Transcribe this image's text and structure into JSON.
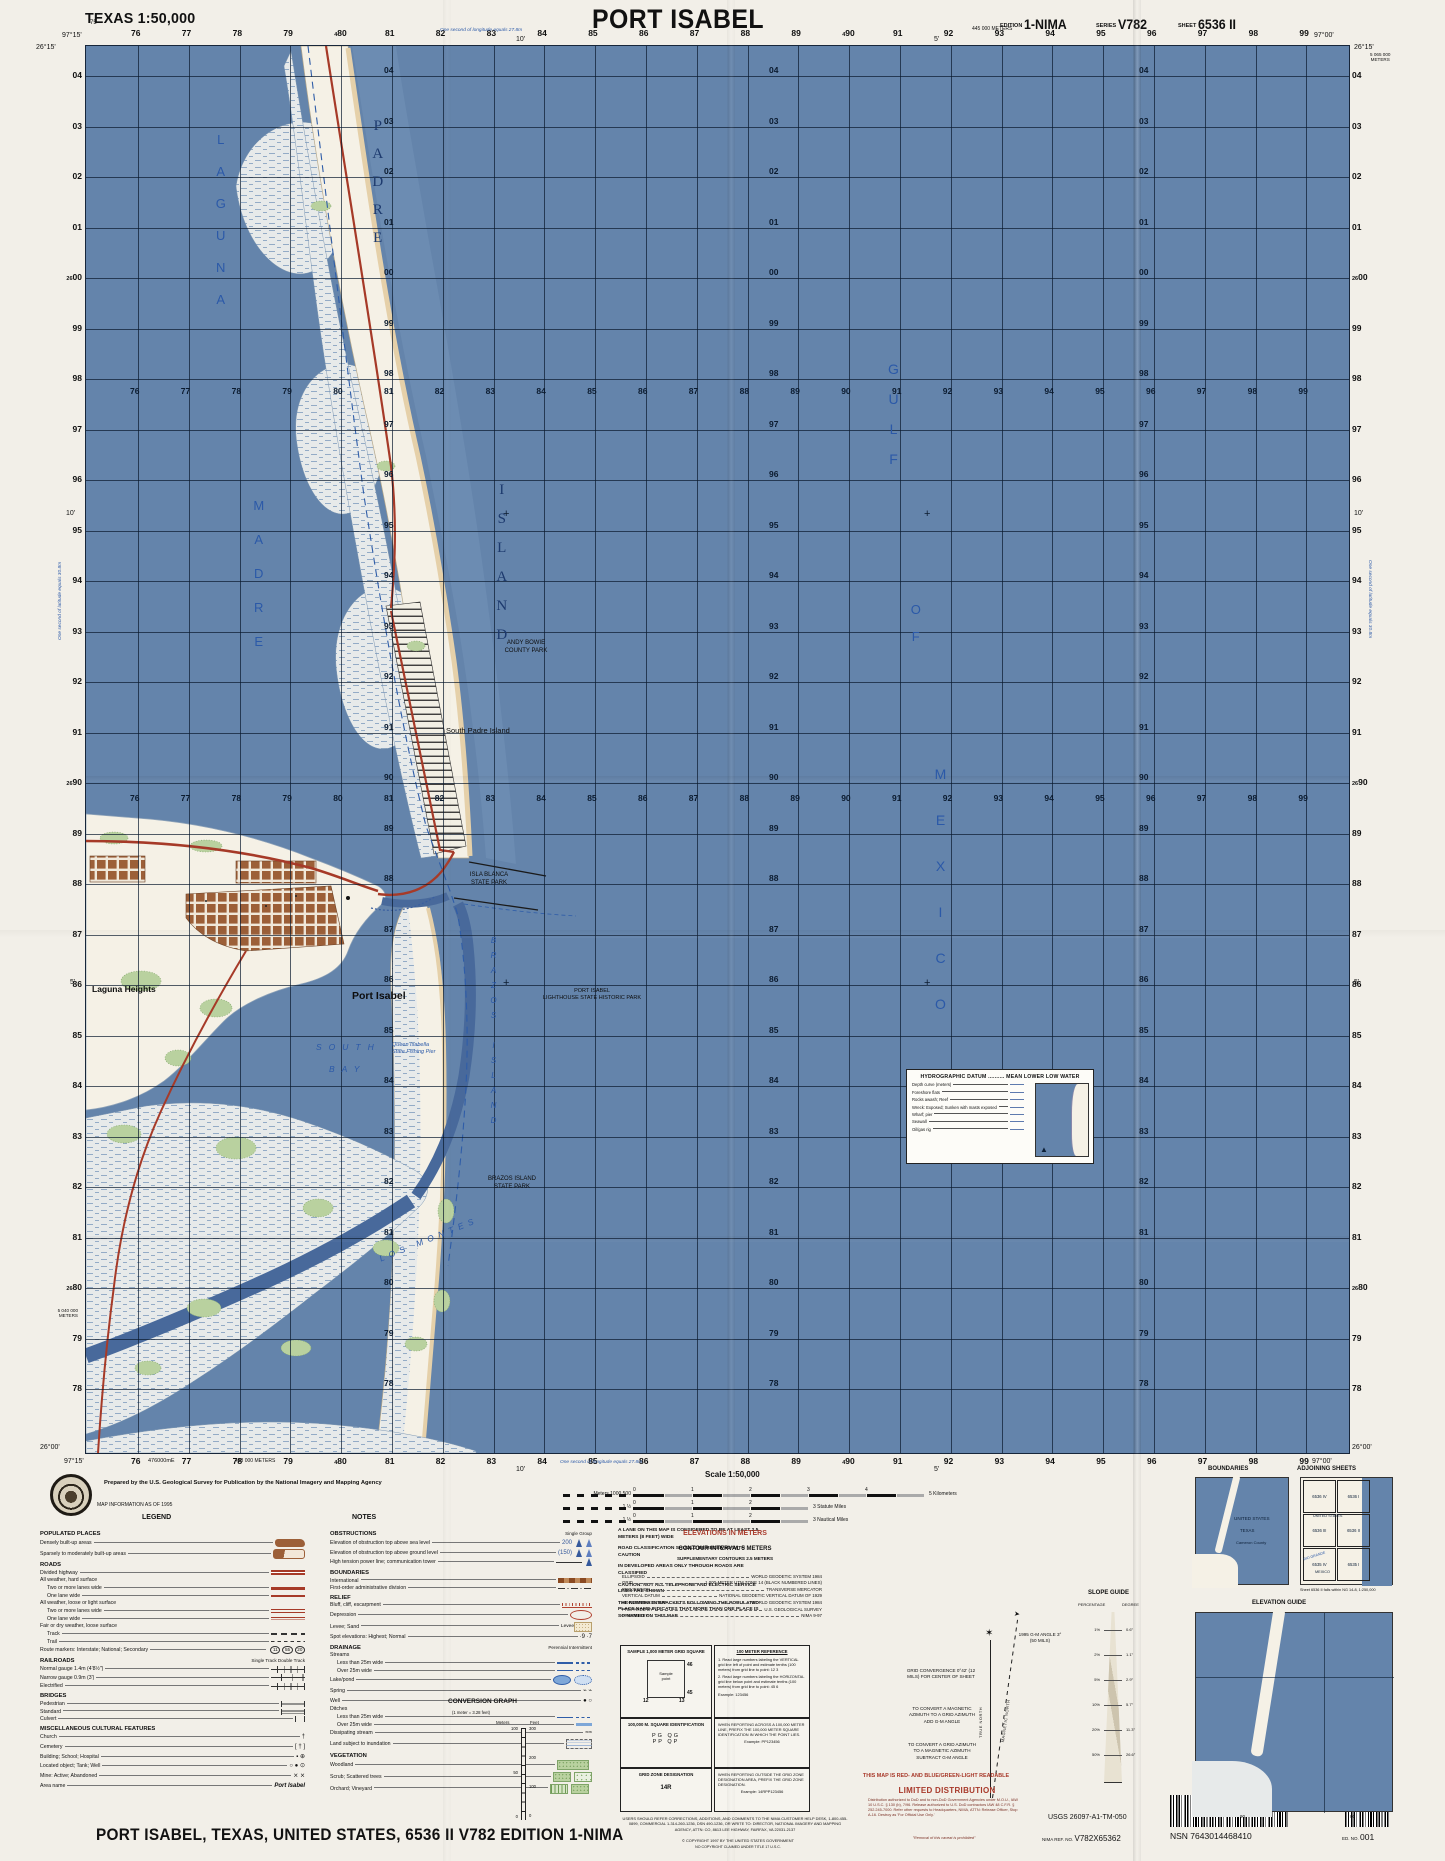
{
  "header": {
    "state_scale": "TEXAS 1:50,000",
    "title": "PORT ISABEL",
    "edition_label": "EDITION",
    "edition": "1-NIMA",
    "series_label": "SERIES",
    "series": "V782",
    "sheet_label": "SHEET",
    "sheet": "6536 II"
  },
  "footer_title": "PORT ISABEL, TEXAS, UNITED STATES,   6536 II   V782   EDITION 1-NIMA",
  "credit": {
    "prepared": "Prepared by the U.S. Geological Survey for Publication by the National Imagery and Mapping Agency",
    "info": "MAP INFORMATION AS OF 1995",
    "legend_heading": "LEGEND",
    "notes_heading": "NOTES"
  },
  "map": {
    "grid": {
      "cols": [
        "76",
        "77",
        "78",
        "79",
        "80",
        "81",
        "82",
        "83",
        "84",
        "85",
        "86",
        "87",
        "88",
        "89",
        "90",
        "91",
        "92",
        "93",
        "94",
        "95",
        "96",
        "97",
        "98",
        "99"
      ],
      "rows": [
        "04",
        "03",
        "02",
        "01",
        "00",
        "99",
        "98",
        "97",
        "96",
        "95",
        "94",
        "93",
        "92",
        "91",
        "90",
        "89",
        "88",
        "87",
        "86",
        "85",
        "84",
        "83",
        "82",
        "81",
        "80",
        "79",
        "78"
      ],
      "row_prefix": "26",
      "col_prefix": "4",
      "prefix_rows": [
        "00",
        "90",
        "80"
      ],
      "prefix_cols": [
        "80",
        "90"
      ]
    },
    "corners": {
      "tl_lon": "97°15'",
      "tl_lat": "26°15'",
      "tr_lon": "97°00'",
      "tr_lat": "26°15'",
      "bl_lat": "26°00'",
      "bl_lon": "97°15'",
      "br_lat": "26°00'",
      "br_lon": "97°00'"
    },
    "edge": {
      "top_m": "445 000 METERS",
      "bottom_m": "433 000 METERS",
      "right_m1": "5 065 000",
      "right_m2": "METERS",
      "left_m1": "5 040 000",
      "left_m2": "METERS",
      "easting": "476000mE",
      "corner75": "75",
      "tick10": "10'",
      "tick5": "5'",
      "lon_note": "One second of longitude equals 27.8m",
      "lat_note": "One second of latitude equals 30.8m"
    },
    "labels": [
      {
        "t": "LAGUNA",
        "x": 126,
        "y": 86,
        "c": "sv",
        "ls": 17,
        "fs": 13
      },
      {
        "t": "MADRE",
        "x": 164,
        "y": 452,
        "c": "sv",
        "ls": 19,
        "fs": 13
      },
      {
        "t": "PADRE",
        "x": 282,
        "y": 72,
        "c": "iv",
        "ls": 12,
        "fs": 15
      },
      {
        "t": "ISLAND",
        "x": 406,
        "y": 436,
        "c": "iv",
        "ls": 13,
        "fs": 15
      },
      {
        "t": "GULF",
        "x": 798,
        "y": 315,
        "c": "sv",
        "ls": 14,
        "fs": 14
      },
      {
        "t": "OF",
        "x": 821,
        "y": 556,
        "c": "sv",
        "ls": 12,
        "fs": 13
      },
      {
        "t": "MEXICO",
        "x": 845,
        "y": 720,
        "c": "sv",
        "ls": 30,
        "fs": 14
      },
      {
        "t": "SOUTH",
        "x": 230,
        "y": 996,
        "c": "sh",
        "ls": 7,
        "fs": 8.5
      },
      {
        "t": "BAY",
        "x": 243,
        "y": 1018,
        "c": "sh",
        "ls": 7,
        "fs": 8.5
      },
      {
        "t": "LOS  MONTES",
        "x": 290,
        "y": 1188,
        "c": "sh",
        "ls": 5,
        "fs": 8.5,
        "r": -22
      },
      {
        "t": "BRAZOS  ISLAND",
        "x": 402,
        "y": 890,
        "c": "ivs",
        "ls": 6,
        "fs": 8
      },
      {
        "t": "Port Isabel",
        "x": 266,
        "y": 944,
        "c": "town",
        "fs": 10.5
      },
      {
        "t": "Laguna Heights",
        "x": 6,
        "y": 938,
        "c": "town",
        "fs": 8.5
      },
      {
        "t": "South Padre Island",
        "x": 360,
        "y": 680,
        "c": "blk",
        "fs": 7.5
      },
      {
        "t": "ANDY BOWIE\nCOUNTY PARK",
        "x": 410,
        "y": 594,
        "c": "park",
        "fs": 6,
        "w": 60
      },
      {
        "t": "ISLA BLANCA\nSTATE PARK",
        "x": 374,
        "y": 826,
        "c": "park",
        "fs": 6,
        "w": 58
      },
      {
        "t": "BRAZOS ISLAND\nSTATE PARK",
        "x": 394,
        "y": 1130,
        "c": "park",
        "fs": 6,
        "w": 64
      },
      {
        "t": "PORT ISABEL\nLIGHTHOUSE STATE HISTORIC PARK",
        "x": 446,
        "y": 942,
        "c": "park",
        "fs": 5.5,
        "w": 120
      },
      {
        "t": "Queen Isabella\nState Fishing Pier",
        "x": 306,
        "y": 996,
        "c": "bluesm",
        "fs": 5.5,
        "w": 55
      }
    ],
    "hydro": {
      "title": "HYDROGRAPHIC DATUM",
      "dots": "..........",
      "value": "MEAN LOWER LOW WATER",
      "rows": [
        "Depth curve (meters)",
        "Foreshore flats",
        "Rocks awash; Reef",
        "Wreck: Exposed; Sunken with masts exposed",
        "Wharf; pier",
        "Seawall",
        "Oil/gas rig"
      ]
    }
  },
  "legend": {
    "col1": [
      {
        "h": "POPULATED PLACES"
      },
      {
        "t": "Densely built-up areas",
        "s": "blob"
      },
      {
        "t": "Sparsely to moderately built-up areas",
        "s": "blob2"
      },
      {
        "h": "ROADS"
      },
      {
        "t": "Divided highway",
        "s": "rdbl"
      },
      {
        "g": "All weather, hard surface"
      },
      {
        "t": "Two or more lanes wide",
        "s": "rthick",
        "ind": 1
      },
      {
        "t": "One lane wide",
        "s": "rthin",
        "ind": 1
      },
      {
        "g": "All weather, loose or light surface"
      },
      {
        "t": "Two or more lanes wide",
        "s": "rpar",
        "ind": 1
      },
      {
        "t": "One lane wide",
        "s": "rparthin",
        "ind": 1
      },
      {
        "g": "Fair or dry weather, loose surface"
      },
      {
        "t": "Track",
        "s": "bdash",
        "ind": 1
      },
      {
        "t": "Trail",
        "s": "bdashf",
        "ind": 1
      },
      {
        "t": "Route markers: Interstate; National; Secondary",
        "s": "shields",
        "v": "11|55|20"
      },
      {
        "h": "RAILROADS",
        "n": "Single Track      Double Track"
      },
      {
        "t": "Normal gauge 1.4m (4'8½\")",
        "s": "rr"
      },
      {
        "t": "Narrow gauge 0.9m (3')",
        "s": "rr2"
      },
      {
        "t": "Electrified",
        "s": "rr"
      },
      {
        "h": "BRIDGES"
      },
      {
        "t": "Pedestrian",
        "s": "br"
      },
      {
        "t": "Standard",
        "s": "br2"
      },
      {
        "t": "Culvert",
        "s": "br3"
      },
      {
        "h": "MISCELLANEOUS CULTURAL FEATURES"
      },
      {
        "t": "Church",
        "s": "txt",
        "v": "†"
      },
      {
        "t": "Cemetery",
        "s": "txt",
        "v": "[ † ]"
      },
      {
        "t": "Building; School; Hospital",
        "s": "txt",
        "v": "▪  ⊕"
      },
      {
        "t": "Located object; Tank; Well",
        "s": "txt",
        "v": "○ ● ⊙"
      },
      {
        "t": "Mine: Active; Abandoned",
        "s": "txt",
        "v": "⨯  ⨯"
      },
      {
        "t": "Area name",
        "s": "txt",
        "v": "Port Isabel",
        "bold": true
      }
    ],
    "col2": [
      {
        "h": "OBSTRUCTIONS",
        "n": "Single    Group"
      },
      {
        "t": "Elevation of obstruction top above sea level",
        "s": "tower",
        "v": "200"
      },
      {
        "t": "Elevation of obstruction top above ground level",
        "s": "tower",
        "v": "(150)"
      },
      {
        "t": "High tension power line; communication tower",
        "s": "power"
      },
      {
        "h": "BOUNDARIES"
      },
      {
        "t": "International",
        "s": "bint"
      },
      {
        "t": "First-order administrative division",
        "s": "badm"
      },
      {
        "h": "RELIEF"
      },
      {
        "t": "Bluff, cliff, escarpment",
        "s": "bluff"
      },
      {
        "t": "Depression",
        "s": "depr"
      },
      {
        "t": "Levee; Sand",
        "s": "levee",
        "v": "Levee"
      },
      {
        "t": "Spot elevations: Highest; Normal",
        "s": "txt",
        "v": "·9    ·7"
      },
      {
        "h": "DRAINAGE",
        "n": "Perennial   Intermittent"
      },
      {
        "g": "Streams"
      },
      {
        "t": "Less than 25m wide",
        "s": "stream",
        "ind": 1
      },
      {
        "t": "Over 25m wide",
        "s": "stream",
        "ind": 1
      },
      {
        "t": "Lake/pond",
        "s": "lake"
      },
      {
        "t": "Spring",
        "s": "txt",
        "v": "⌁   ⌁"
      },
      {
        "t": "Well",
        "s": "txt",
        "v": "●   ○"
      },
      {
        "g": "Ditches"
      },
      {
        "t": "Less than 25m wide",
        "s": "stream",
        "ind": 1
      },
      {
        "t": "Over 25m wide",
        "s": "ditch2",
        "ind": 1
      },
      {
        "t": "Dissipating stream",
        "s": "txt",
        "v": "≈≈"
      },
      {
        "t": "Land subject to inundation",
        "s": "inund"
      },
      {
        "h": "VEGETATION"
      },
      {
        "t": "Woodland",
        "s": "veg1"
      },
      {
        "t": "Scrub; Scattered trees",
        "s": "veg2"
      },
      {
        "t": "Orchard; Vineyard",
        "s": "veg3"
      }
    ]
  },
  "notes": {
    "items": [
      "A LANE ON THIS MAP IS CONSIDERED TO BE AT LEAST 2.5 METERS (8 FEET) WIDE",
      "ROAD CLASSIFICATION SHOULD BE RECEIVED WITH CAUTION",
      "IN DEVELOPED AREAS ONLY THROUGH ROADS ARE CLASSIFIED",
      "CAUTION: NOT ALL TELEPHONE AND ELECTRIC SERVICE LINES ARE SHOWN",
      "THE NUMBER IN BRACKETS FOLLOWING THE POPULATED PLACE NAME INDICATES THAT MORE THAN ONE PLACE IS SO NAMED ON THIS MAP"
    ]
  },
  "scale": {
    "heading": "Scale 1:50,000",
    "bars": [
      {
        "pre": "Meters 1000        500",
        "ticks": [
          "0",
          "1",
          "2",
          "3",
          "4"
        ],
        "end": "5 Kilometers"
      },
      {
        "pre": "1                 ½",
        "ticks": [
          "0",
          "1",
          "2"
        ],
        "end": "3 Statute Miles"
      },
      {
        "pre": "1                 ½",
        "ticks": [
          "0",
          "1",
          "2"
        ],
        "end": "3 Nautical Miles"
      }
    ]
  },
  "elev": {
    "heading": "ELEVATIONS IN METERS",
    "ci": "CONTOUR INTERVAL 5 METERS",
    "supp": "SUPPLEMENTARY CONTOURS 2.5 METERS"
  },
  "datum": [
    [
      "ELLIPSOID",
      "WORLD GEODETIC SYSTEM 1984"
    ],
    [
      "GRID",
      "1,000-METER UTM ZONE 14 (BLACK NUMBERED LINES)"
    ],
    [
      "PROJECTION",
      "TRANSVERSE MERCATOR"
    ],
    [
      "VERTICAL DATUM",
      "NATIONAL GEODETIC VERTICAL DATUM OF 1929"
    ],
    [
      "HORIZONTAL DATUM",
      "WORLD GEODETIC SYSTEM 1984"
    ],
    [
      "PREPARED BY",
      "U.S. GEOLOGICAL SURVEY"
    ],
    [
      "PRINTED BY",
      "NIMA 9-97"
    ]
  ],
  "gridref": {
    "sample": {
      "title": "SAMPLE 1,000 METER GRID SQUARE",
      "pt": "Sample\npoint",
      "top": "46",
      "bottom": "45",
      "left": "12",
      "right": "13"
    },
    "ref": {
      "title": "100 METER REFERENCE",
      "steps": [
        "1.  Read large numbers labeling the VERTICAL grid line left of point and estimate tenths (100 meters) from grid line to point:  12 3",
        "2.  Read large numbers labeling the HORIZONTAL grid line below point and estimate tenths (100 meters) from grid line to point:  45 6",
        "Example:  123456"
      ]
    },
    "sq": {
      "title": "100,000 M. SQUARE IDENTIFICATION",
      "cells": "PG QG\nPP QP"
    },
    "zone": {
      "title": "GRID ZONE DESIGNATION",
      "value": "14R"
    },
    "across": "WHEN REPORTING ACROSS A 100,000 METER LINE, PREFIX THE 100,000 METER SQUARE IDENTIFICATION IN WHICH THE POINT LIES.",
    "ex1": "Example:  PP123456",
    "outside": "WHEN REPORTING OUTSIDE THE GRID ZONE DESIGNATION AREA, PREFIX THE GRID ZONE DESIGNATION.",
    "ex2": "Example:  14RPP123456"
  },
  "conv": {
    "title": "CONVERSION GRAPH",
    "sub": "(1 meter = 3.28 feet)",
    "left": "Meters",
    "right": "Feet",
    "feet": [
      "300",
      "200",
      "100",
      "0"
    ],
    "meters": [
      "100",
      "50",
      "0"
    ]
  },
  "decl": {
    "gm_head": "1995",
    "gm": "G-M ANGLE",
    "gm_val": "3° (50 MILS)",
    "conv_title": "GRID CONVERGENCE",
    "conv_val": "0°42' (12 MILS)",
    "conv_for": "FOR CENTER OF SHEET",
    "c1": "TO CONVERT A MAGNETIC AZIMUTH TO A GRID AZIMUTH ADD G-M ANGLE",
    "c2": "TO CONVERT A GRID AZIMUTH TO A MAGNETIC AZIMUTH SUBTRACT G-M ANGLE",
    "tn": "TRUE NORTH",
    "mn": "MAGNETIC NORTH"
  },
  "dist": {
    "readable": "THIS MAP IS RED- AND BLUE/GREEN-LIGHT READABLE",
    "heading": "LIMITED DISTRIBUTION",
    "body": "Distribution authorized to DoD and to non-DoD Government Agencies under M.O.U., IAW 10 U.S.C. § 130 (b), 7/96. Release authorized to U.S. DoD contractors IAW 48 C.F.R. § 252.245-7000. Refer other requests to Headquarters, NIMA, ATTN: Release Officer, Stop A-16. Destroy as 'For Official Use Only.'",
    "removal": "\"Removal of this caveat is prohibited\"",
    "users": "USERS SHOULD REFER CORRECTIONS, ADDITIONS, AND COMMENTS TO THE NIMA CUSTOMER HELP DESK, 1-800-455-0899, COMMERCIAL 1-314-260-1236, DSN 490-1236, OR WRITE TO: DIRECTOR, NATIONAL IMAGERY AND MAPPING AGENCY, ATTN: CO, 8613 LEE HIGHWAY, FAIRFAX, VA 22031-2137",
    "copy1": "© COPYRIGHT 1997 BY THE UNITED STATES GOVERNMENT",
    "copy2": "NO COPYRIGHT CLAIMED UNDER TITLE 17 U.S.C."
  },
  "ids": {
    "usgs": "USGS 26097-A1-TM-050",
    "nima_label": "NIMA REF. NO.",
    "nima": "V782X65362",
    "nsn": "NSN 7643014468410",
    "ed_label": "ED. NO.",
    "ed": "001"
  },
  "panels": {
    "boundaries": {
      "heading": "BOUNDARIES",
      "l1": "UNITED STATES",
      "l2": "TEXAS",
      "l3": "Cameron County"
    },
    "adjoining": {
      "heading": "ADJOINING SHEETS",
      "rows": [
        [
          "6536 IV",
          "6536 I"
        ],
        [
          "6536 III",
          "6536 II"
        ],
        [
          "6535 IV",
          "6535 I"
        ]
      ],
      "top": "UNITED STATES",
      "bottom": "MEXICO",
      "river": "RIO GRANDE",
      "note": "Sheet 6536 II falls within NG 14-8, 1:250,000"
    },
    "elevation": {
      "heading": "ELEVATION GUIDE",
      "ticks": [
        "90",
        "00"
      ]
    },
    "slope": {
      "heading": "SLOPE GUIDE",
      "col1": "PERCENTAGE",
      "col2": "DEGREE",
      "rows": [
        [
          "1%",
          "0.6°"
        ],
        [
          "2%",
          "1.1°"
        ],
        [
          "5%",
          "2.9°"
        ],
        [
          "10%",
          "5.7°"
        ],
        [
          "20%",
          "11.3°"
        ],
        [
          "50%",
          "26.6°"
        ]
      ]
    }
  },
  "colors": {
    "water": "#6484ab",
    "channel": "#48699b",
    "land": "#f5f1e6",
    "beach": "#e5d0a9",
    "green": "#b9d19f",
    "town": "#9c5f38",
    "road": "#a63a28",
    "sea_label": "#2b59a8",
    "red_margin": "#a8392a"
  }
}
